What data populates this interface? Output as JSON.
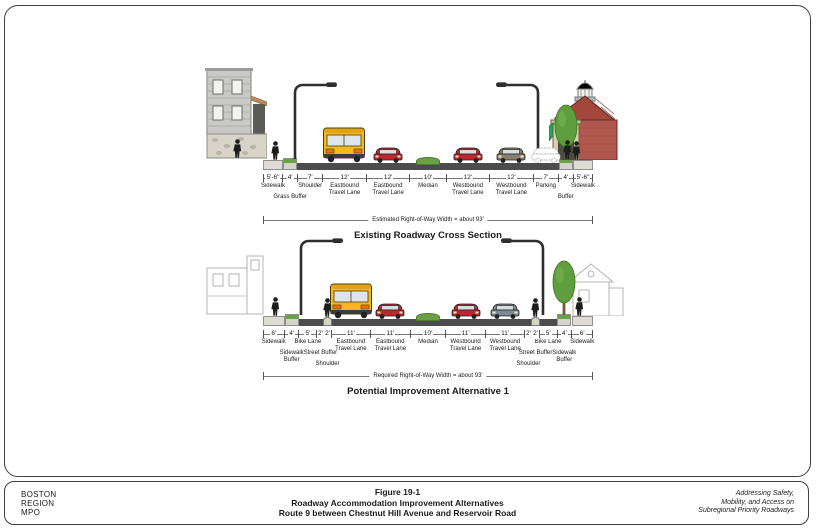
{
  "colors": {
    "border": "#3f3f3f",
    "road": "#4c4c4c",
    "grass": "#69a244",
    "bus_yellow": "#f5b91e",
    "car_red": "#c0272d",
    "car_brown": "#8a7f6e",
    "car_gray": "#7d8a94",
    "brick": "#b2574d",
    "awning_green": "#2f9e57"
  },
  "existing": {
    "caption": "Existing Roadway Cross Section",
    "row_label": "Estimated Right-of-Way Width = about 93'",
    "segments": [
      {
        "width": "5'-6\"",
        "label": "Sidewalk",
        "feet": 5.5,
        "tier": 0
      },
      {
        "width": "4'",
        "label": "Grass Buffer",
        "feet": 4,
        "tier": 1
      },
      {
        "width": "7'",
        "label": "Shoulder",
        "feet": 7,
        "tier": 0
      },
      {
        "width": "12'",
        "label": "Eastbound Travel Lane",
        "feet": 12,
        "tier": 0
      },
      {
        "width": "12'",
        "label": "Eastbound Travel Lane",
        "feet": 12,
        "tier": 0
      },
      {
        "width": "10'",
        "label": "Median",
        "feet": 10,
        "tier": 0
      },
      {
        "width": "12'",
        "label": "Westbound Travel Lane",
        "feet": 12,
        "tier": 0
      },
      {
        "width": "12'",
        "label": "Westbound Travel Lane",
        "feet": 12,
        "tier": 0
      },
      {
        "width": "7'",
        "label": "Parking",
        "feet": 7,
        "tier": 0
      },
      {
        "width": "4'",
        "label": "Buffer",
        "feet": 4,
        "tier": 1
      },
      {
        "width": "5'-6\"",
        "label": "Sidewalk",
        "feet": 5.5,
        "tier": 0
      }
    ]
  },
  "alternative": {
    "caption": "Potential Improvement Alternative 1",
    "row_label": "Required Right-of-Way Width = about 93'",
    "segments": [
      {
        "width": "6'",
        "label": "Sidewalk",
        "feet": 6,
        "tier": 0
      },
      {
        "width": "4'",
        "label": "Sidewalk Buffer",
        "feet": 4,
        "tier": 1
      },
      {
        "width": "5'",
        "label": "Bike Lane",
        "feet": 5,
        "tier": 0
      },
      {
        "width": "2'",
        "label": "Street Buffer",
        "feet": 2,
        "tier": 1
      },
      {
        "width": "2'",
        "label": "Shoulder",
        "feet": 2,
        "tier": 2
      },
      {
        "width": "11'",
        "label": "Eastbound Travel Lane",
        "feet": 11,
        "tier": 0
      },
      {
        "width": "11'",
        "label": "Eastbound Travel Lane",
        "feet": 11,
        "tier": 0
      },
      {
        "width": "10'",
        "label": "Median",
        "feet": 10,
        "tier": 0
      },
      {
        "width": "11'",
        "label": "Westbound Travel Lane",
        "feet": 11,
        "tier": 0
      },
      {
        "width": "11'",
        "label": "Westbound Travel Lane",
        "feet": 11,
        "tier": 0
      },
      {
        "width": "2'",
        "label": "Shoulder",
        "feet": 2,
        "tier": 2
      },
      {
        "width": "2'",
        "label": "Street Buffer",
        "feet": 2,
        "tier": 1
      },
      {
        "width": "5'",
        "label": "Bike Lane",
        "feet": 5,
        "tier": 0
      },
      {
        "width": "4'",
        "label": "Sidewalk Buffer",
        "feet": 4,
        "tier": 1
      },
      {
        "width": "6'",
        "label": "Sidewalk",
        "feet": 6,
        "tier": 0
      }
    ]
  },
  "footer": {
    "org": [
      "BOSTON",
      "REGION",
      "MPO"
    ],
    "figure_label": "Figure 19-1",
    "title_line1": "Roadway Accommodation Improvement Alternatives",
    "title_line2": "Route 9 between Chestnut Hill Avenue and Reservoir Road",
    "tagline": [
      "Addressing Safety,",
      "Mobility, and Access on",
      "Subregional Priority Roadways"
    ]
  }
}
